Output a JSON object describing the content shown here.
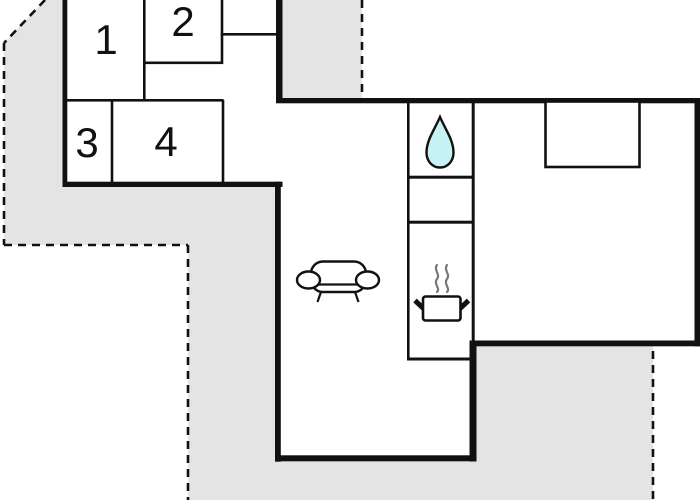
{
  "plan": {
    "type": "floor-plan",
    "room_numbers": [
      "1",
      "2",
      "3",
      "4"
    ],
    "icons": [
      "water-drop-icon",
      "cooking-pot-icon",
      "sofa-icon",
      "bed"
    ],
    "colors": {
      "wall": "#111111",
      "terrace": "#e4e4e4",
      "water-drop": "#c7f2f4",
      "steam": "#777777",
      "background": "#ffffff",
      "label": "#111111"
    }
  }
}
